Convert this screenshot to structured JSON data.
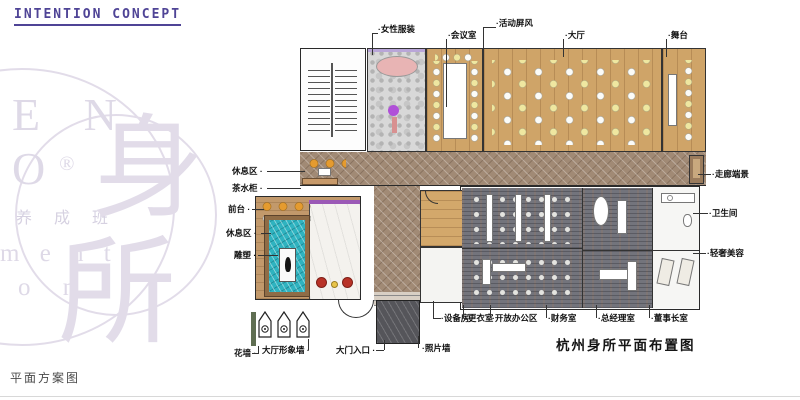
{
  "header": {
    "title": "INTENTION CONCEPT"
  },
  "watermark": {
    "letters_top": "E N",
    "letter_o": "O",
    "registered": "®",
    "cn_line": "养 成 班",
    "letters_mid": "m e n t",
    "letters_bottom": "o n",
    "seal_char_top": "身",
    "seal_char_bottom": "所"
  },
  "plan": {
    "caption": "杭州身所平面布置图",
    "callouts": {
      "top": [
        "·女性服装",
        "·会议室",
        "·活动屏风",
        "·大厅",
        "·舞台"
      ],
      "right": [
        "·走廊端景",
        "·卫生间",
        "·轻奢美容"
      ],
      "left": [
        "休息区 ·",
        "茶水柜 ·",
        "前台 ·",
        "休息区 ·",
        "雕塑 ·"
      ],
      "bottom_row1": [
        "·设备房",
        "·更衣室",
        "·开放办公区",
        "·财务室",
        "·总经理室",
        "·董事长室"
      ],
      "bottom_row2": [
        "花墙 ·",
        "大厅形象墙 ·",
        "大门入口 ·",
        "·照片墙"
      ]
    }
  },
  "footer": {
    "caption": "平面方案图"
  },
  "colors": {
    "title_purple": "#4f4496",
    "watermark": "#d9d3e3",
    "wood_floor": "#cfa468",
    "herringbone_corridor": "#a18a75",
    "pool_teal": "#2fb3c0",
    "chair_yellow": "#efe7a0",
    "chair_orange": "#e59b2f",
    "chair_red": "#b83227",
    "accent_purple": "#9b59b6",
    "office_carpet": "#73747c"
  }
}
